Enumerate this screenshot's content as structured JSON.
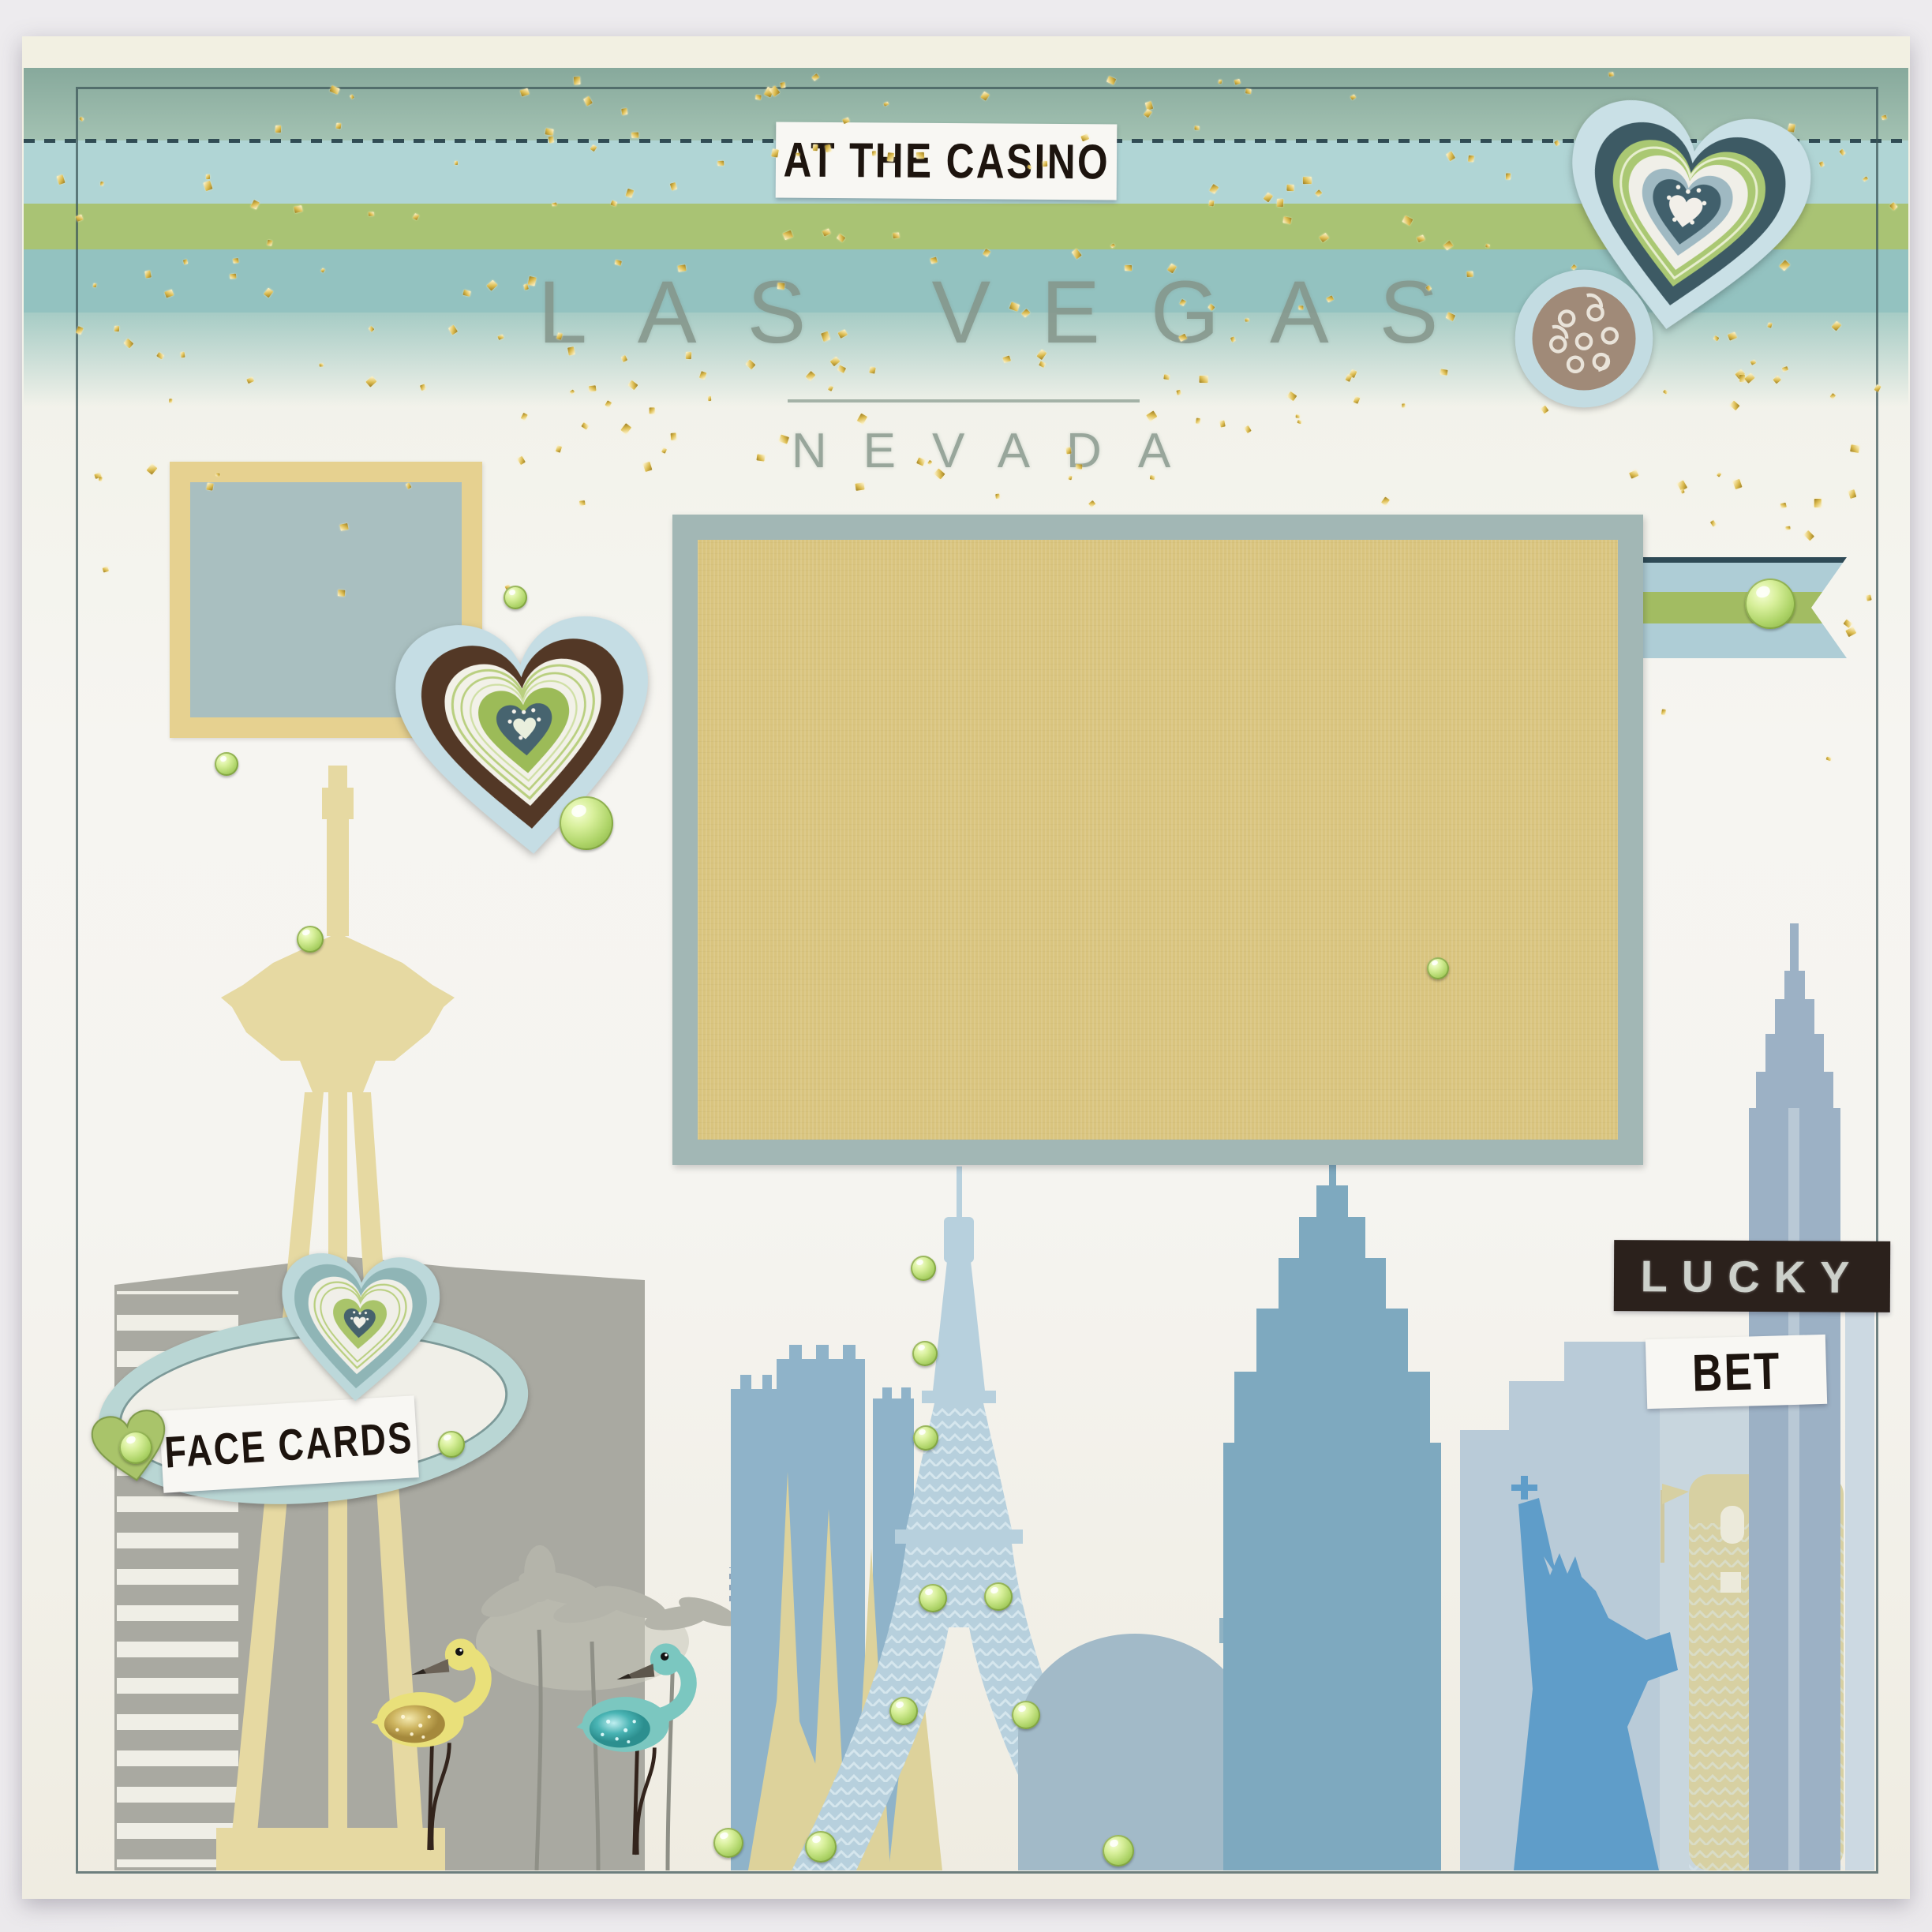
{
  "photo": {
    "type": "photograph of a scrapbook page",
    "theme": "Las Vegas casino travel scrapbook layout"
  },
  "texts": {
    "title": "LAS VEGAS",
    "subtitle": "NEVADA",
    "casino_sticker": "AT THE CASINO",
    "lucky_sticker": "LUCKY",
    "bet_sticker": "BET",
    "face_cards_sticker": "FACE CARDS"
  },
  "embellishments": {
    "hearts": [
      "layered blue-navy-green heart with filigree medallion (top right)",
      "layered blue-brown-green heart with green gem (left)",
      "layered blue-green heart above FACE CARDS oval",
      "small green heart with gem on FACE CARDS oval"
    ],
    "flamingos": [
      "yellow flamingo pin with gold glitter wing and wire legs",
      "teal flamingo pin with teal glitter wing and wire legs"
    ],
    "gems": "round green rhinestones scattered over the page and Eiffel Tower",
    "ribbon": "gold-glitter tulle over sage, aqua and green ribbon bands",
    "banner": "notched pennant ribbon with green stripe and green gem",
    "photo_mats": [
      "large yellow cardstock photo mat on blue-gray mat",
      "small dusty-blue square with yellow frame"
    ]
  },
  "skyline": [
    "Stratosphere tower (yellow)",
    "Excalibur castle (blue)",
    "yellow spires",
    "Eiffel Tower with green gems (light blue)",
    "casino dome",
    "stepped casino tower",
    "Statue of Liberty",
    "yellow windowed tower with flag",
    "Chrysler-style building",
    "gray palm trees and striped ladder block"
  ],
  "colors": {
    "page_cream": "#f3f1e7",
    "accent_green": "#a9c374",
    "accent_teal": "#93c2c0",
    "accent_blue": "#aecdd6",
    "mat_yellow": "#d9c47e",
    "mat_blue_gray": "#a2b7b5",
    "sticker_black": "#2b211c",
    "gem_green": "#b5d96e",
    "skyline_blue": "#7ea9bf",
    "skyline_yellow": "#e6d9a2"
  }
}
